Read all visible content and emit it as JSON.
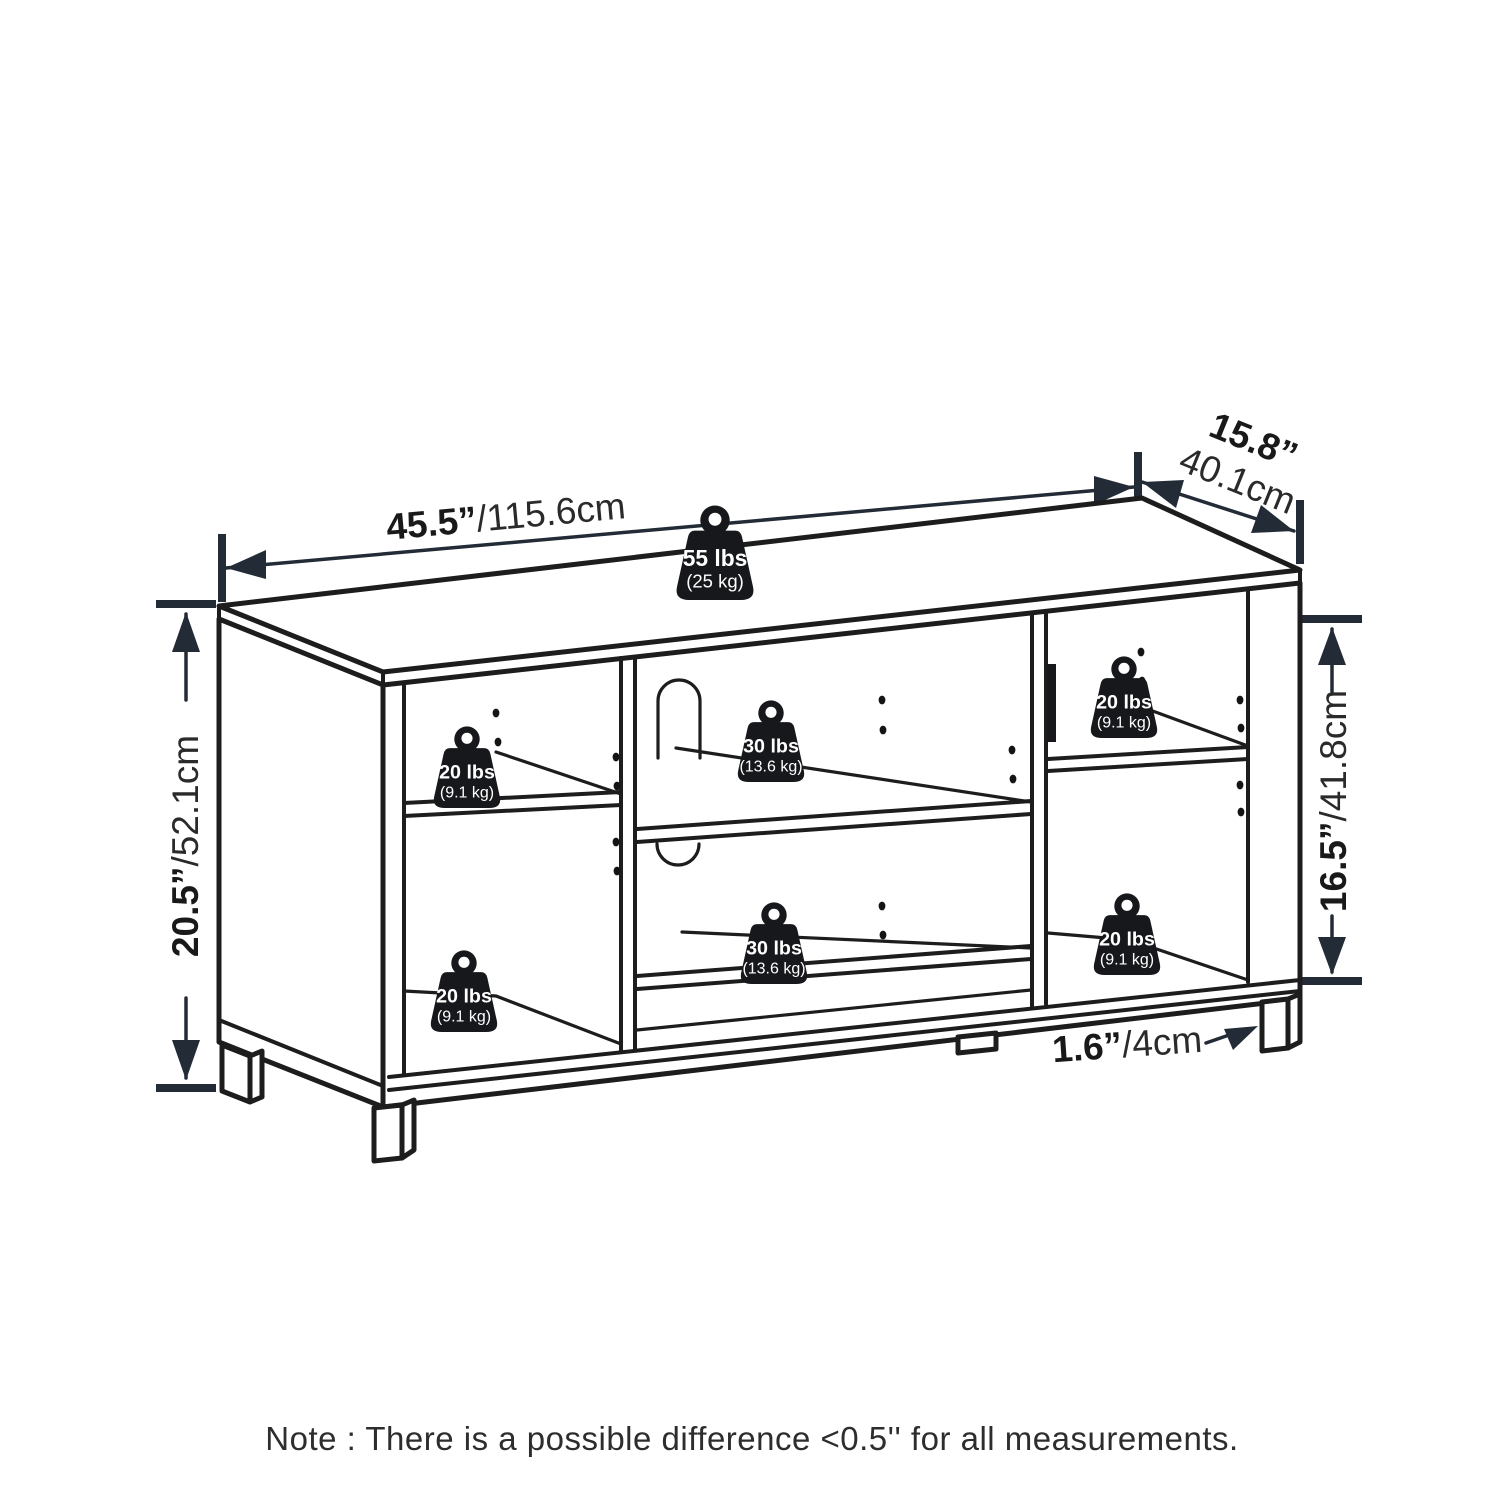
{
  "colors": {
    "background": "#ffffff",
    "line": "#1d1d1d",
    "dimension": "#232b36",
    "badge_fill": "#17181c",
    "badge_text": "#ffffff"
  },
  "dimensions": {
    "width": {
      "primary": "45.5”",
      "secondary": "/115.6cm"
    },
    "depth": {
      "primary": "15.8”",
      "secondary": "40.1cm"
    },
    "height": {
      "primary": "20.5”",
      "secondary": "/52.1cm"
    },
    "interior_height": {
      "primary": "16.5”",
      "secondary": "/41.8cm"
    },
    "leg_height": {
      "primary": "1.6”",
      "secondary": "/4cm"
    }
  },
  "load_ratings": {
    "top_surface": {
      "lbs": "55 lbs",
      "kg": "(25 kg)"
    },
    "left_upper_shelf": {
      "lbs": "20 lbs",
      "kg": "(9.1 kg)"
    },
    "left_lower_shelf": {
      "lbs": "20 lbs",
      "kg": "(9.1 kg)"
    },
    "middle_upper_shelf": {
      "lbs": "30 lbs",
      "kg": "(13.6 kg)"
    },
    "middle_lower_shelf": {
      "lbs": "30 lbs",
      "kg": "(13.6 kg)"
    },
    "right_upper_shelf": {
      "lbs": "20 lbs",
      "kg": "(9.1 kg)"
    },
    "right_lower_shelf": {
      "lbs": "20 lbs",
      "kg": "(9.1 kg)"
    }
  },
  "note": "Note : There is a possible difference <0.5'' for all measurements."
}
